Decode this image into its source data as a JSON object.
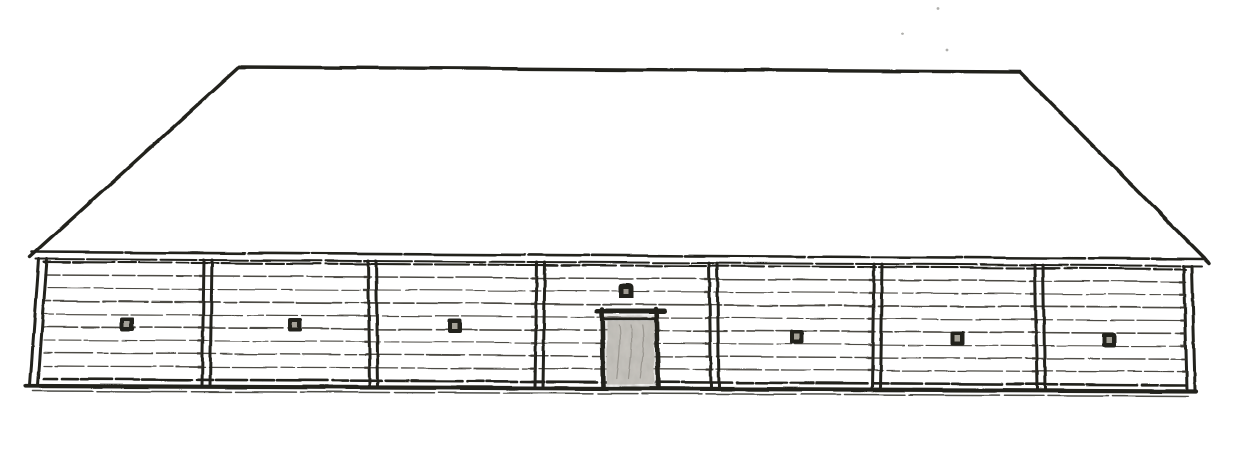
{
  "drawing_name": "hand-drawn-longhouse-front-elevation-sketch",
  "colors": {
    "paper": "#ffffff",
    "ink": "#21201d",
    "ink_soft": "#38342e",
    "plank_line": "#3d3a33",
    "door_leaf": "#c9c6c0",
    "door_leaf_shade": "#6b6760",
    "window_inner": "#b4b0a6",
    "speck": "#8d8d89"
  },
  "canvas": {
    "width": 1254,
    "height": 473
  },
  "roof": {
    "eave_left": {
      "x": 30,
      "y": 257
    },
    "apex_left": {
      "x": 239,
      "y": 67
    },
    "apex_right": {
      "x": 1020,
      "y": 72
    },
    "eave_right": {
      "x": 1209,
      "y": 263
    },
    "stroke_width": 3.4
  },
  "fascia": {
    "top": {
      "x1": 32,
      "y1": 252,
      "x2": 1206,
      "y2": 259,
      "stroke": 2.6
    },
    "bottom": {
      "x1": 36,
      "y1": 259,
      "x2": 1202,
      "y2": 266,
      "stroke": 2.0
    }
  },
  "wall": {
    "left": 42,
    "right": 1188,
    "top_y_left": 262,
    "top_y_right": 269,
    "bottom_y_left": 379,
    "bottom_y_right": 385,
    "plank_rows": 9
  },
  "posts": {
    "gap": 8,
    "stroke": 3.0,
    "items": [
      {
        "x": 39,
        "tilt": -9
      },
      {
        "x": 204,
        "tilt": -2
      },
      {
        "x": 368,
        "tilt": 2
      },
      {
        "x": 537,
        "tilt": -2
      },
      {
        "x": 709,
        "tilt": 2
      },
      {
        "x": 874,
        "tilt": -2
      },
      {
        "x": 1035,
        "tilt": 2
      },
      {
        "x": 1184,
        "tilt": 3
      }
    ]
  },
  "windows": {
    "size": 14,
    "items": [
      {
        "x": 120,
        "y": 317
      },
      {
        "x": 288,
        "y": 318
      },
      {
        "x": 448,
        "y": 319
      },
      {
        "x": 790,
        "y": 330
      },
      {
        "x": 951,
        "y": 331
      },
      {
        "x": 1102,
        "y": 333
      }
    ]
  },
  "door": {
    "jamb_left_x": 602,
    "jamb_right_x": 656,
    "top_y": 309,
    "bottom_y": 387,
    "jamb_stroke": 4.6,
    "lintel": {
      "x1": 597,
      "x2": 664,
      "y": 311,
      "stroke": 5.0
    },
    "lintel_inner": {
      "x1": 604,
      "x2": 657,
      "y": 319,
      "stroke": 2.6
    },
    "leaf": {
      "x": 607,
      "y": 321,
      "width": 47,
      "height": 63
    },
    "transom_window": {
      "x": 619,
      "y": 283,
      "width": 15,
      "height": 15
    }
  },
  "ground": {
    "main": {
      "x1": 26,
      "y1": 386,
      "x2": 1196,
      "y2": 391,
      "stroke": 4.2
    },
    "lower": {
      "x1": 33,
      "y1": 391,
      "x2": 1188,
      "y2": 396,
      "stroke": 1.5
    }
  },
  "specks": [
    {
      "x": 938,
      "y": 8
    },
    {
      "x": 902,
      "y": 34
    },
    {
      "x": 947,
      "y": 50
    }
  ]
}
